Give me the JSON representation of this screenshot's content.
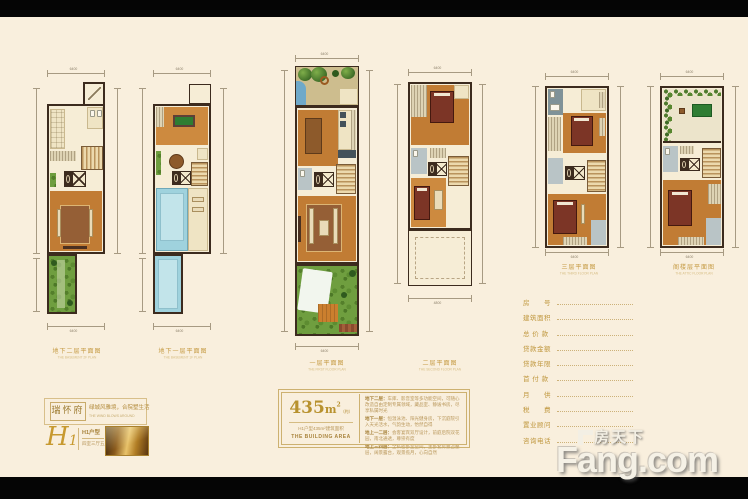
{
  "page": {
    "background": "#f9efdd",
    "letterbox": "#050505",
    "accent_gold": "#c59a42"
  },
  "plans": [
    {
      "cn": "地下二层平面图",
      "en": "THE BASEMENT 2F PLAN",
      "dim_top": "6400",
      "dim_bottom": "6400"
    },
    {
      "cn": "地下一层平面图",
      "en": "THE BASEMENT 1F PLAN",
      "dim_top": "6400",
      "dim_bottom": "6400"
    },
    {
      "cn": "一层平面图",
      "en": "THE FIRST FLOOR PLAN",
      "dim_top": "6400",
      "dim_bottom": "6400"
    },
    {
      "cn": "二层平面图",
      "en": "THE SECOND FLOOR PLAN",
      "dim_top": "6400",
      "dim_bottom": "4800"
    },
    {
      "cn": "三层平面图",
      "en": "THE THIRD FLOOR PLAN",
      "dim_top": "6400",
      "dim_bottom": "6400"
    },
    {
      "cn": "阁楼层平面图",
      "en": "THE ATTIC FLOOR PLAN",
      "dim_top": "6400",
      "dim_bottom": "6400"
    }
  ],
  "brand": {
    "name": "瑞怀府",
    "tagline": "绿城风雅境，合院墅生活",
    "tagline_en": "THE WIND BLOWS AROUND",
    "script": "H",
    "script_num": "1",
    "unit": "H1户型",
    "rooms": "四室三厅五卫"
  },
  "area_box": {
    "num": "435",
    "unit": "m",
    "sup": "2",
    "approx": "（约）",
    "sub_cn": "H1户型435m²建筑面积",
    "sub_en": "THE BUILDING AREA",
    "details": [
      {
        "label": "地下二层：",
        "text": "车库、影音室等多功能空间，可随心改造自由定制专属领域，藏品室、静谧书房，尽享私属时光"
      },
      {
        "label": "地下一层：",
        "text": "恒温泳池、阳光健身房，下沉庭院引入天光活水，气韵生动，怡然自得"
      },
      {
        "label": "地上一二层：",
        "text": "会客宴宾双厅设计，前庭后院双花园，南北通透，尊崇有度"
      },
      {
        "label": "地上三四层：",
        "text": "全私密卧室空间，主卧套房独占整层，阔景露台，观景揽月，心向自然"
      }
    ]
  },
  "form": {
    "rows": [
      "房　　号",
      "建筑面积",
      "总 价 款",
      "贷款金额",
      "贷款年限",
      "首 付 款",
      "月　　供",
      "税　　费",
      "置业顾问",
      "咨询电话"
    ]
  },
  "watermark": {
    "cn": "房天下",
    "en": "Fang.com"
  }
}
